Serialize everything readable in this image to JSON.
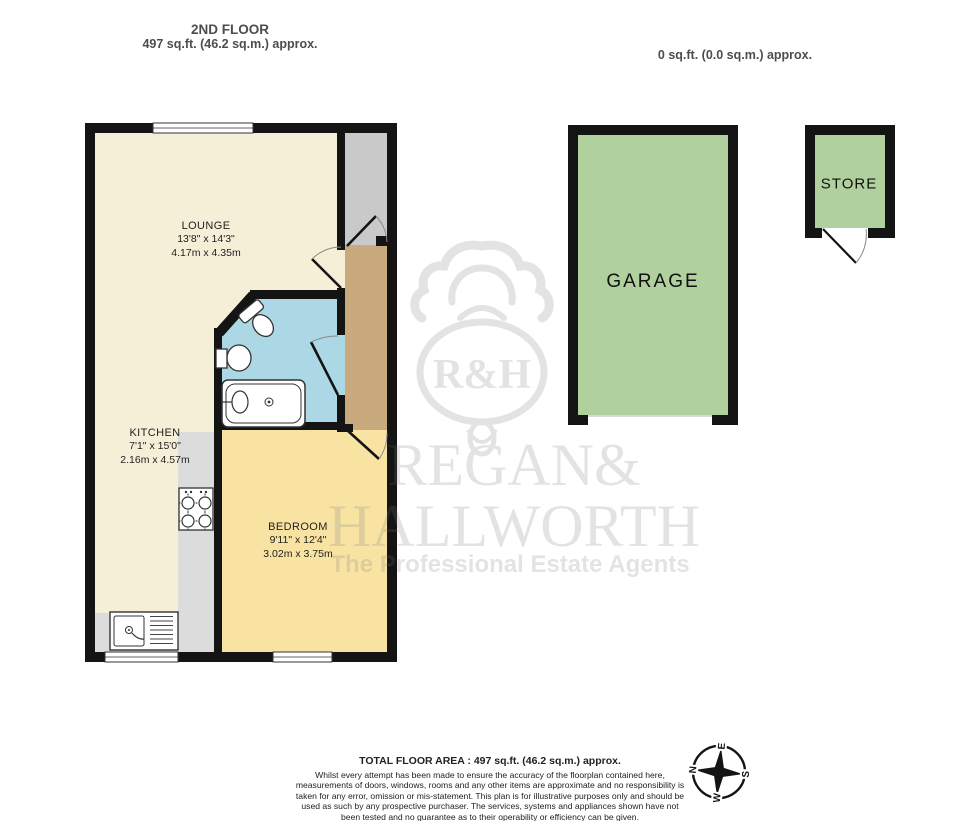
{
  "page": {
    "floor_header": {
      "title": "2ND FLOOR",
      "area": "497 sq.ft. (46.2 sq.m.) approx."
    },
    "outbuilding_header": {
      "area": "0 sq.ft. (0.0 sq.m.) approx."
    }
  },
  "rooms": {
    "lounge": {
      "name": "LOUNGE",
      "dims_imperial": "13'8\" x 14'3\"",
      "dims_metric": "4.17m x 4.35m"
    },
    "kitchen": {
      "name": "KITCHEN",
      "dims_imperial": "7'1\" x 15'0\"",
      "dims_metric": "2.16m x 4.57m"
    },
    "bedroom": {
      "name": "BEDROOM",
      "dims_imperial": "9'11\" x 12'4\"",
      "dims_metric": "3.02m x 3.75m"
    },
    "garage": {
      "name": "GARAGE"
    },
    "store": {
      "name": "STORE"
    }
  },
  "watermark": {
    "monogram": "R&H",
    "line1": "REGAN&",
    "line2": "HALLWORTH",
    "tagline": "The Professional Estate Agents"
  },
  "compass": {
    "n": "N",
    "e": "E",
    "s": "S",
    "w": "W"
  },
  "footer": {
    "total_area": "TOTAL FLOOR AREA : 497 sq.ft. (46.2 sq.m.) approx.",
    "disclaimer": "Whilst every attempt has been made to ensure the accuracy of the floorplan contained here, measurements of doors, windows, rooms and any other items are approximate and no responsibility is taken for any error, omission or mis-statement. This plan is for illustrative purposes only and should be used as such by any prospective purchaser. The services, systems and appliances shown have not been tested and no guarantee as to their operability or efficiency can be given.",
    "credit": "Made with Metropix ©2025"
  },
  "colors": {
    "lounge_kitchen": "#F6EFD8",
    "bedroom": "#F8E3A3",
    "bathroom": "#ACD7E5",
    "hall": "#C9A97E",
    "landing": "#C9C9C9",
    "counter": "#DCDCDC",
    "outbuilding": "#B0D09E",
    "wall": "#141414",
    "watermark": "#777777"
  }
}
